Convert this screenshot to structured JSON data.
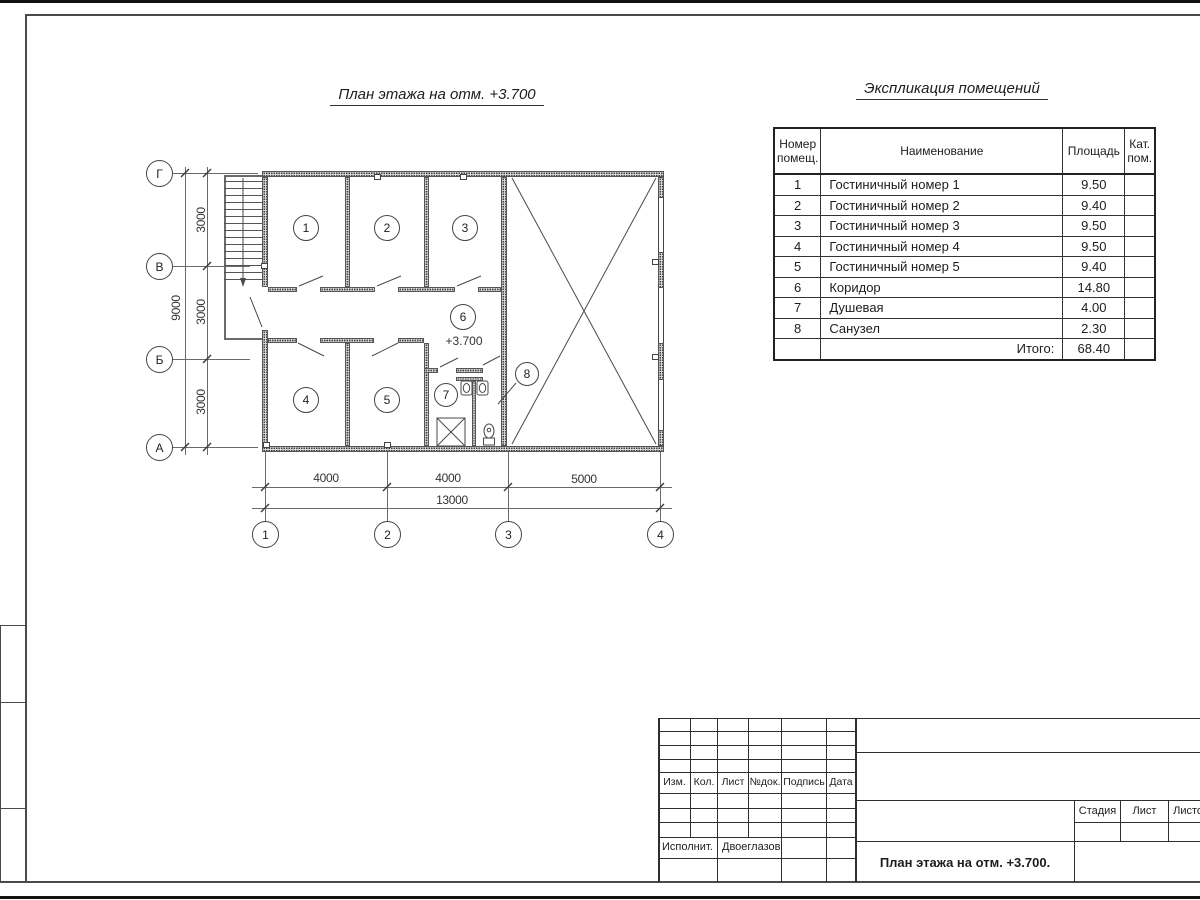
{
  "plan": {
    "title": "План этажа на отм. +3.700",
    "elevation": "+3.700"
  },
  "axes": {
    "horizontal": [
      "Г",
      "В",
      "Б",
      "А"
    ],
    "vertical": [
      "1",
      "2",
      "3",
      "4"
    ]
  },
  "dims": {
    "v_segments": [
      "3000",
      "3000",
      "3000"
    ],
    "v_total": "9000",
    "h_segments": [
      "4000",
      "4000",
      "5000"
    ],
    "h_total": "13000"
  },
  "rooms": [
    "1",
    "2",
    "3",
    "4",
    "5",
    "6",
    "7",
    "8"
  ],
  "explication": {
    "title": "Экспликация помещений",
    "headers": {
      "number_l1": "Номер",
      "number_l2": "помещ.",
      "name": "Наименование",
      "area": "Площадь",
      "cat_l1": "Кат.",
      "cat_l2": "пом."
    },
    "rows": [
      {
        "num": "1",
        "name": "Гостиничный номер 1",
        "area": "9.50"
      },
      {
        "num": "2",
        "name": "Гостиничный номер 2",
        "area": "9.40"
      },
      {
        "num": "3",
        "name": "Гостиничный номер 3",
        "area": "9.50"
      },
      {
        "num": "4",
        "name": "Гостиничный номер 4",
        "area": "9.50"
      },
      {
        "num": "5",
        "name": "Гостиничный номер 5",
        "area": "9.40"
      },
      {
        "num": "6",
        "name": "Коридор",
        "area": "14.80"
      },
      {
        "num": "7",
        "name": "Душевая",
        "area": "4.00"
      },
      {
        "num": "8",
        "name": "Санузел",
        "area": "2.30"
      }
    ],
    "total_label": "Итого:",
    "total_area": "68.40"
  },
  "title_block": {
    "cols": [
      "Изм.",
      "Кол.",
      "Лист",
      "№док.",
      "Подпись",
      "Дата"
    ],
    "executor_label": "Исполнит.",
    "executor_name": "Двоеглазов",
    "stage_label": "Стадия",
    "sheet_label": "Лист",
    "sheets_label": "Листов",
    "doc_title": "План этажа на отм. +3.700."
  }
}
